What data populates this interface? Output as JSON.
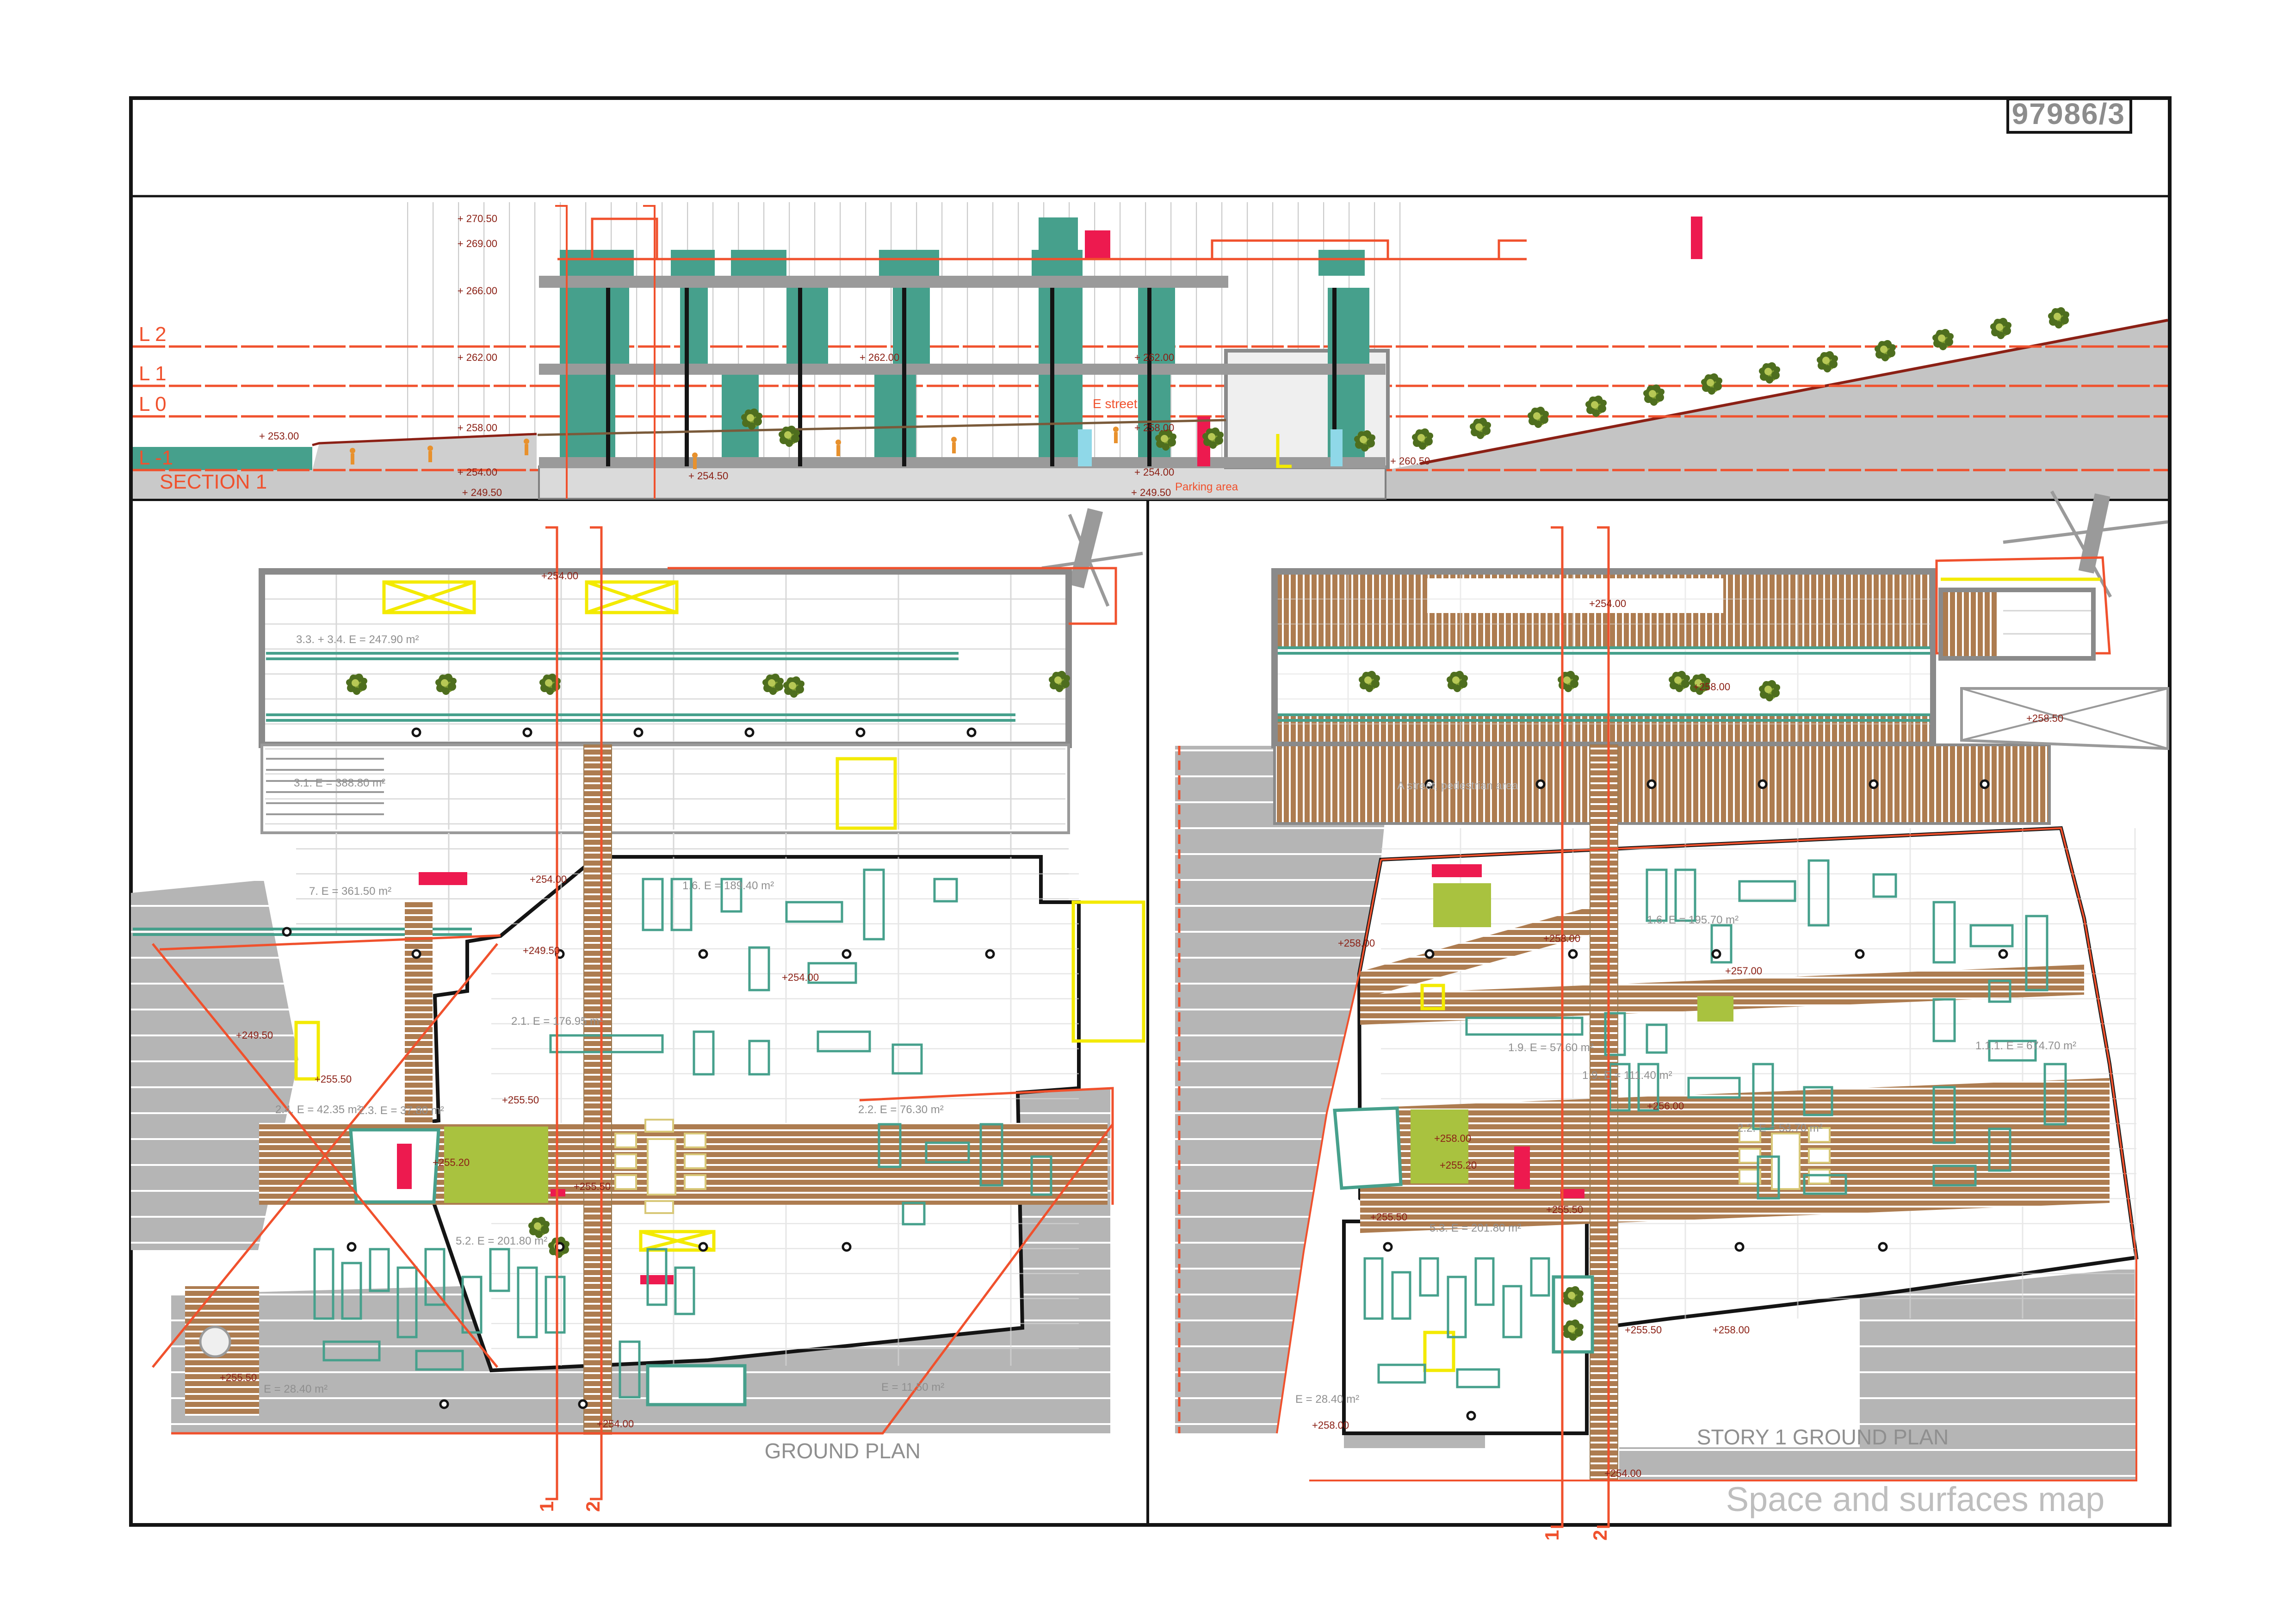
{
  "sheet": {
    "number": "97986/3"
  },
  "colors": {
    "teal": "#46A08C",
    "orange_red": "#F0512D",
    "dark_red": "#8B2015",
    "crimson": "#ED1A4F",
    "yellow": "#F3EA00",
    "lime": "#A9C23F",
    "deck_brown": "#AD7C50",
    "terrain_gray": "#B5B5B5",
    "slab": "#9A9A9A",
    "cyan": "#8FD8E8",
    "label_gray": "#8F8F8F",
    "title_gray": "#8C8C8C",
    "frame": "#141414"
  },
  "section": {
    "title": "SECTION 1",
    "levels": [
      "L 2",
      "L 1",
      "L 0",
      "L -1"
    ],
    "street_label": "E street",
    "parking_label": "Parking area",
    "elevations": [
      "+ 270.50",
      "+ 269.00",
      "+ 266.00",
      "+ 262.00",
      "+ 258.00",
      "+ 254.00",
      "+ 249.50",
      "+ 262.00",
      "+ 262.00",
      "+ 258.00",
      "+ 254.00",
      "+ 249.50",
      "+ 253.00",
      "+ 254.50",
      "+ 260.50"
    ]
  },
  "plans": {
    "left": {
      "title": "GROUND PLAN",
      "cut_markers": [
        "1",
        "2"
      ],
      "labels": [
        "3.3. + 3.4. E = 247.90 m²",
        "3.1. E = 388.80 m²",
        "7. E = 361.50 m²",
        "1.6. E = 189.40 m²",
        "2.1. E = 176.95 m²",
        "2.4. E = 42.35 m²",
        "2.3. E = 37.80 m²",
        "2.2. E = 76.30 m²",
        "5.2. E = 201.80 m²",
        "E = 28.40 m²",
        "E = 11.50 m²"
      ],
      "elevations": [
        "+254.00",
        "+254.00",
        "+249.50",
        "+249.50",
        "+254.00",
        "+255.50",
        "+255.20",
        "+255.50",
        "+255.50",
        "+255.50",
        "+254.00"
      ]
    },
    "right": {
      "title": "STORY 1 GROUND PLAN",
      "subtitle": "Space and surfaces map",
      "street_label": "A street, pedestrian area",
      "cut_markers": [
        "1",
        "2"
      ],
      "labels": [
        "1.6. E = 195.70 m²",
        "1.9. E = 57.60 m²",
        "1.9. E = 111.40 m²",
        "1.1.1. E = 674.70 m²",
        "2.2. E = 53.70 m²",
        "5.3. E = 201.80 m²",
        "E = 28.40 m²"
      ],
      "elevations": [
        "+254.00",
        "+258.00",
        "+258.00",
        "+257.00",
        "+258.00",
        "+256.00",
        "+258.00",
        "+255.20",
        "+255.50",
        "+255.50",
        "+255.50",
        "+258.00",
        "+258.00",
        "+254.00",
        "+258.50"
      ]
    }
  }
}
